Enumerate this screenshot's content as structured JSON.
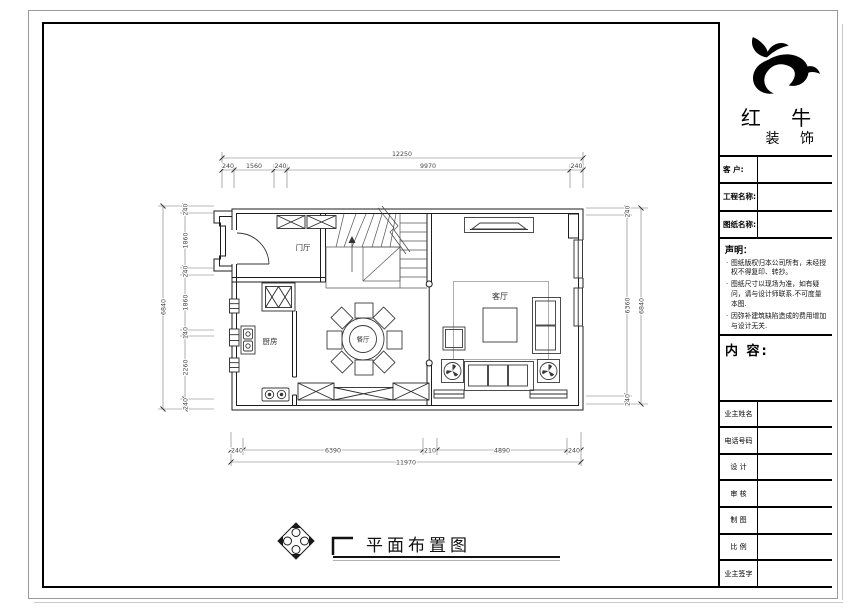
{
  "title_block": {
    "brand_name": "红 牛",
    "brand_sub": "装 饰",
    "info_fields": [
      {
        "label": "客  户:"
      },
      {
        "label": "工程名称:"
      },
      {
        "label": "图纸名称:"
      }
    ],
    "statement_heading": "声明：",
    "statement_notes": [
      "图纸版权归本公司所有，未经授权不得复印、转抄。",
      "图纸尺寸以现场为准，如有疑问，请与设计师联系.不可度量本图.",
      "因弥补建筑缺陷造成的费用增加与设计无关."
    ],
    "content_heading": "内 容:",
    "sign_fields": [
      {
        "label": "业主姓名"
      },
      {
        "label": "电话号码"
      },
      {
        "label": "设 计"
      },
      {
        "label": "审 核"
      },
      {
        "label": "制 图"
      },
      {
        "label": "比 例"
      },
      {
        "label": "业主签字"
      }
    ]
  },
  "plan": {
    "drawing_title": "平面布置图",
    "rooms": {
      "entry": "门厅",
      "kitchen": "厨房",
      "dining": "餐厅",
      "living": "客厅"
    },
    "dims": {
      "top_total": "12250",
      "top_segments": [
        "240",
        "1560",
        "240",
        "9970",
        "240"
      ],
      "bottom_segments": [
        "240",
        "6390",
        "210",
        "4890",
        "240"
      ],
      "bottom_total": "11970",
      "left_segments": [
        "240",
        "1860",
        "240",
        "1860",
        "140",
        "2260",
        "240"
      ],
      "left_total": "6840",
      "right_segments": [
        "240",
        "6360",
        "240"
      ],
      "right_total": "6840"
    }
  }
}
